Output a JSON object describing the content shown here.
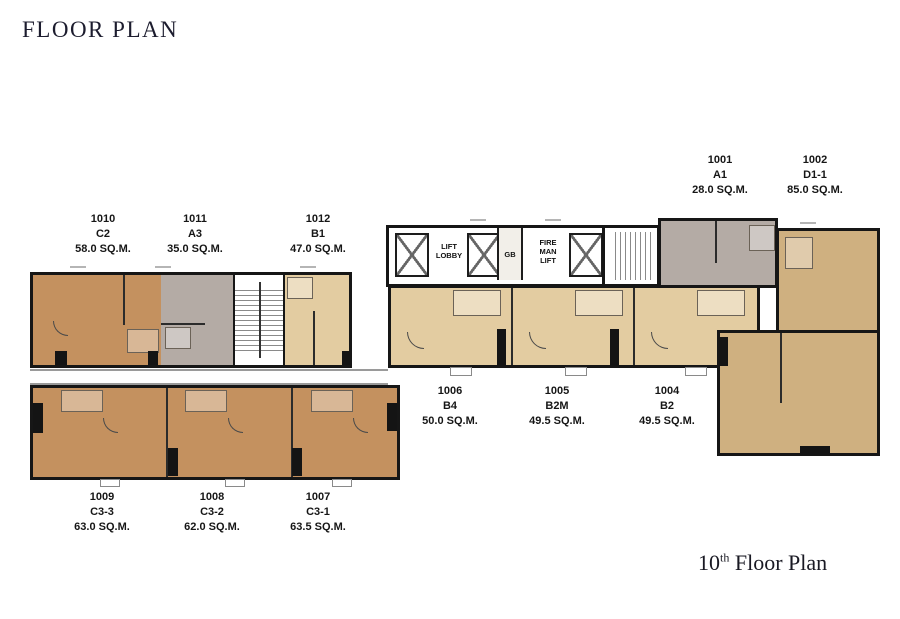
{
  "title": "FLOOR PLAN",
  "caption": {
    "number": "10",
    "suffix": "th",
    "rest": " Floor Plan"
  },
  "core": {
    "lift_lobby": "LIFT LOBBY",
    "gb": "GB",
    "fire_man_lift": "FIRE MAN LIFT"
  },
  "units": [
    {
      "no": "1010",
      "type": "C2",
      "area": "58.0 SQ.M."
    },
    {
      "no": "1011",
      "type": "A3",
      "area": "35.0 SQ.M."
    },
    {
      "no": "1012",
      "type": "B1",
      "area": "47.0 SQ.M."
    },
    {
      "no": "1001",
      "type": "A1",
      "area": "28.0 SQ.M."
    },
    {
      "no": "1002",
      "type": "D1-1",
      "area": "85.0 SQ.M."
    },
    {
      "no": "1006",
      "type": "B4",
      "area": "50.0 SQ.M."
    },
    {
      "no": "1005",
      "type": "B2M",
      "area": "49.5 SQ.M."
    },
    {
      "no": "1004",
      "type": "B2",
      "area": "49.5 SQ.M."
    },
    {
      "no": "1009",
      "type": "C3-3",
      "area": "63.0 SQ.M."
    },
    {
      "no": "1008",
      "type": "C3-2",
      "area": "62.0 SQ.M."
    },
    {
      "no": "1007",
      "type": "C3-1",
      "area": "63.5 SQ.M."
    }
  ],
  "colors": {
    "type_a_gray": "#b4aba5",
    "type_b_tan": "#e3cca1",
    "type_c_brown": "#c4915f",
    "type_d_khaki": "#cfb080",
    "wall": "#161616",
    "heading_text": "#1c1c2e"
  },
  "icons": {
    "lift_shaft": "x-crossed-box",
    "staircase": "tread-lines"
  }
}
